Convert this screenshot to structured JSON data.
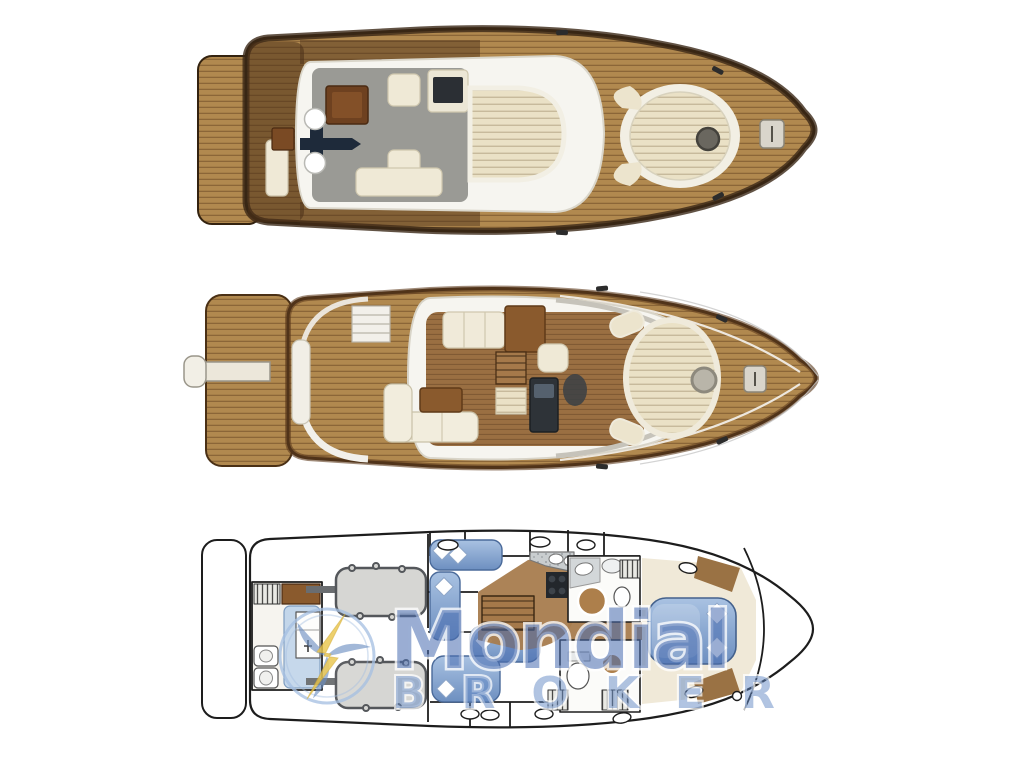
{
  "watermark": {
    "brand": "Mondial",
    "subtitle": "BROKER",
    "brand_color": "#4a6eb2",
    "subtitle_color": "#6086c2",
    "outline_color": "#ffffff",
    "logo_icon": "lightning-turbine-icon",
    "logo_ring_color": "#a6c0e2",
    "logo_bolt_color": "#e9c54d",
    "logo_blade_color": "#6c8fc0"
  },
  "illustration": {
    "type": "yacht-deck-plans",
    "plan_count": 3,
    "colors": {
      "background": "#ffffff",
      "teak_wood": "#b1894f",
      "dark_walnut": "#4a2f18",
      "hull_outline": "#2f1f0e",
      "upholstery_cream": "#efe9d6",
      "sunpad_cream": "#eae1c6",
      "deck_white": "#f6f5f0",
      "flybridge_floor_gray": "#9a9a95",
      "salon_floor": "#9a6f42",
      "berth_blue": "#8badd6",
      "engine_gray": "#d6d6d3",
      "stove_black": "#23272c",
      "plan_line": "#1d1d1d"
    }
  }
}
